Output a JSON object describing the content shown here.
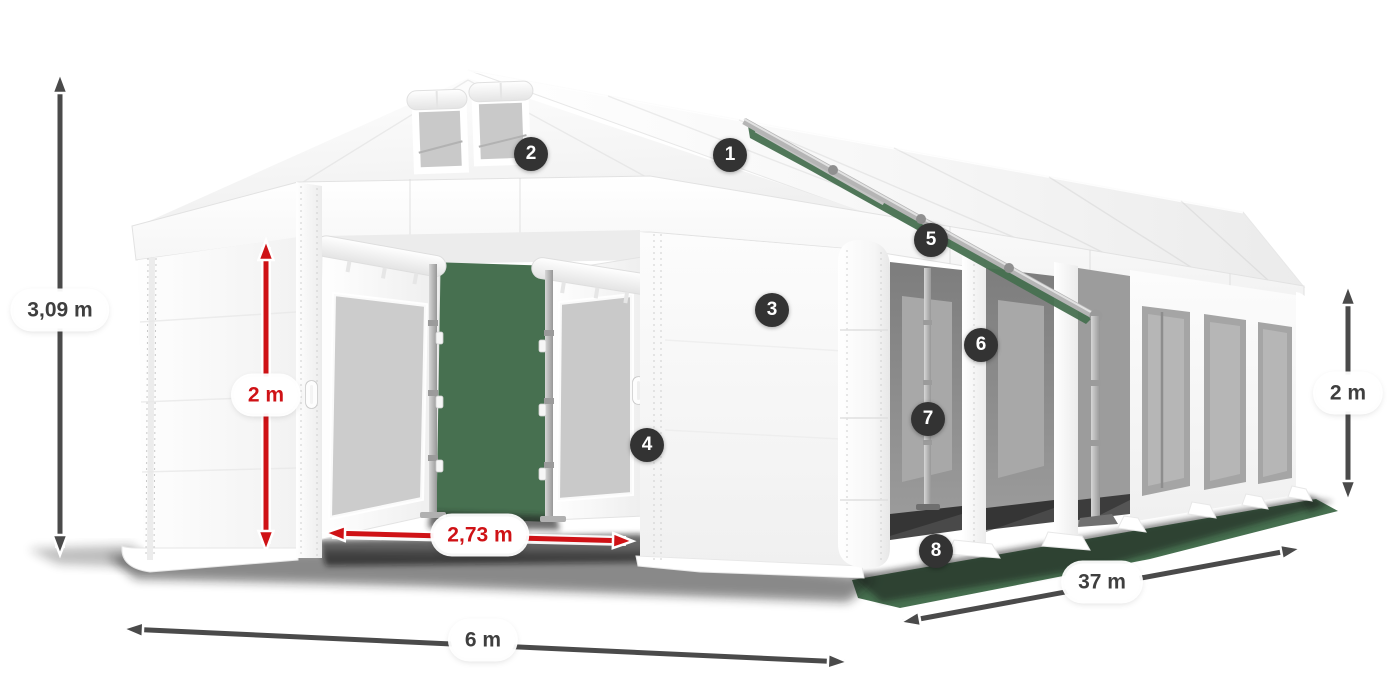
{
  "diagram_title": "tent-dimensions-diagram",
  "badges": [
    "1",
    "2",
    "3",
    "4",
    "5",
    "6",
    "7",
    "8"
  ],
  "measurements": [
    {
      "id": "total-height",
      "label": "3,09 m",
      "style": "dark"
    },
    {
      "id": "entrance-height",
      "label": "2 m",
      "style": "red"
    },
    {
      "id": "entrance-width",
      "label": "2,73 m",
      "style": "red"
    },
    {
      "id": "tent-width",
      "label": "6 m",
      "style": "dark"
    },
    {
      "id": "tent-length",
      "label": "37 m",
      "style": "dark"
    },
    {
      "id": "side-height",
      "label": "2 m",
      "style": "dark"
    }
  ],
  "colors": {
    "accent_red": "#cf1216",
    "dimension_gray": "#4a4a4a",
    "badge_bg": "#333333",
    "grass_green": "#477050"
  }
}
